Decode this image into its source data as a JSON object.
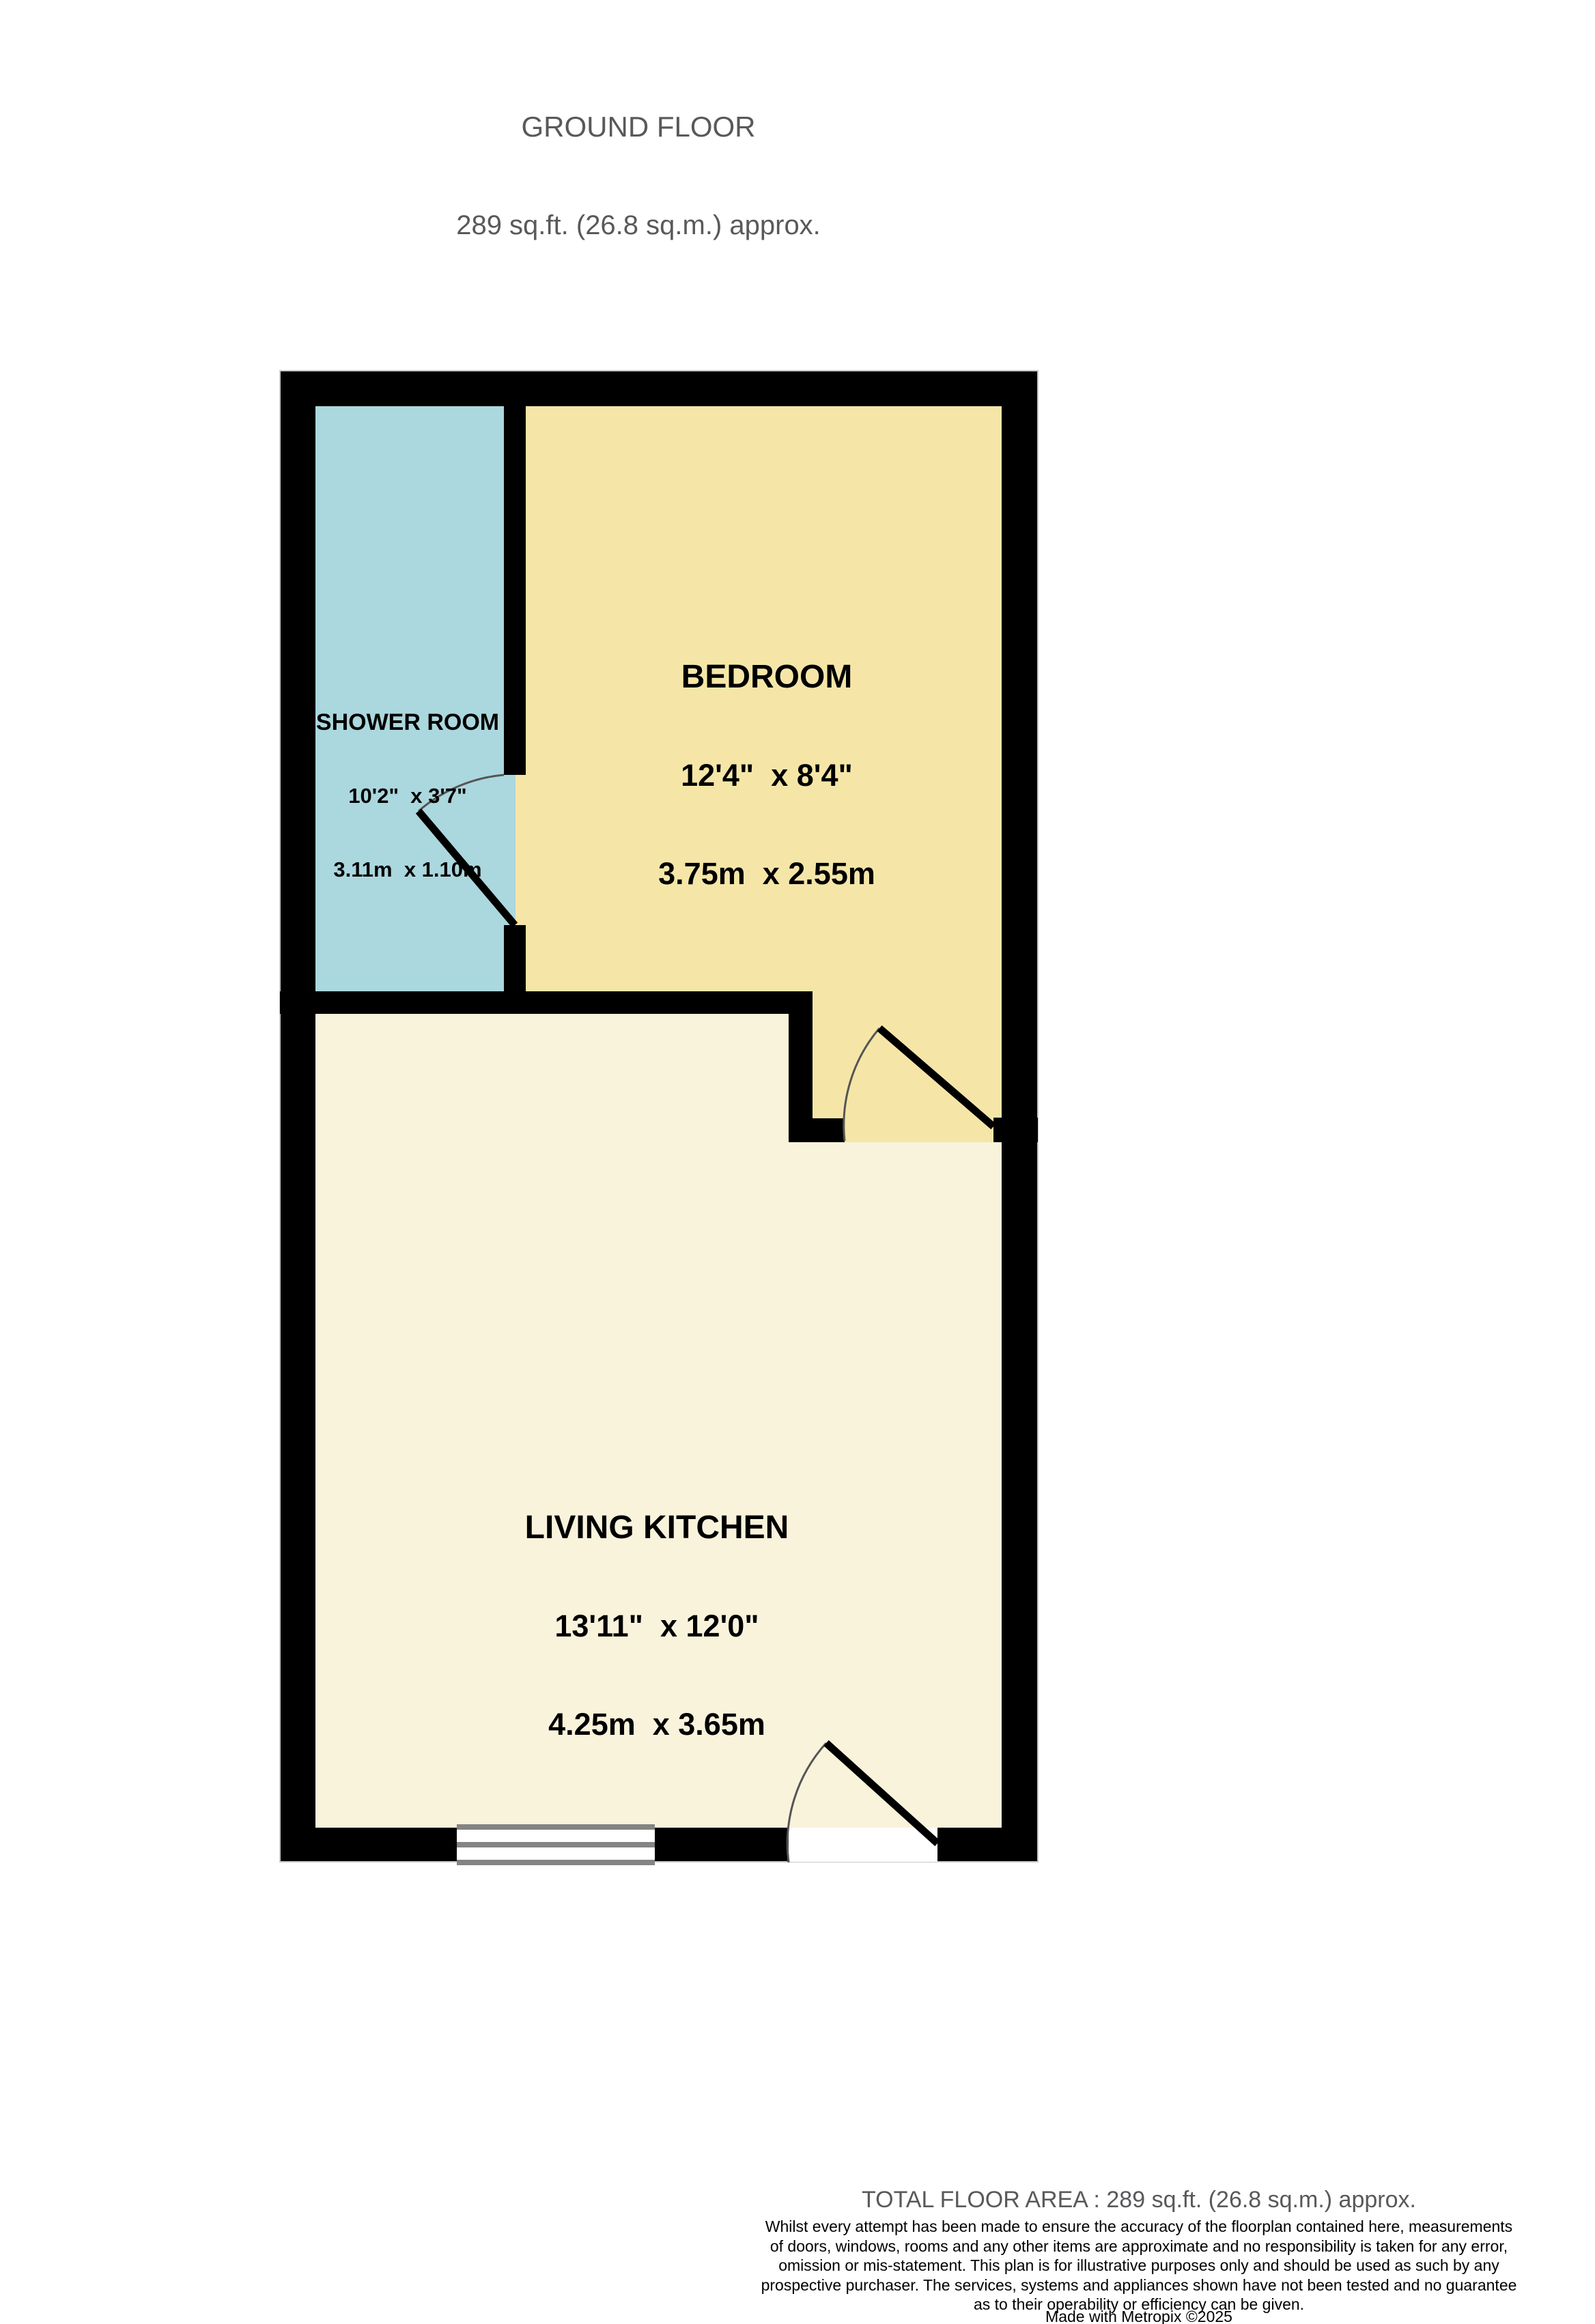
{
  "header": {
    "title": "GROUND FLOOR",
    "subtitle": "289 sq.ft. (26.8 sq.m.) approx."
  },
  "rooms": [
    {
      "name": "SHOWER ROOM",
      "imperial": "10'2\"  x 3'7\"",
      "metric": "3.11m  x 1.10m",
      "fill": "#abd7de"
    },
    {
      "name": "BEDROOM",
      "imperial": "12'4\"  x 8'4\"",
      "metric": "3.75m  x 2.55m",
      "fill": "#f5e6a8"
    },
    {
      "name": "LIVING KITCHEN",
      "imperial": "13'11\"  x 12'0\"",
      "metric": "4.25m  x 3.65m",
      "fill": "#f9f3dc"
    }
  ],
  "footer": {
    "total_area": "TOTAL FLOOR AREA : 289 sq.ft. (26.8 sq.m.) approx.",
    "disclaimer": "Whilst every attempt has been made to ensure the accuracy of the floorplan contained here, measurements\nof doors, windows, rooms and any other items are approximate and no responsibility is taken for any error,\nomission or mis-statement. This plan is for illustrative purposes only and should be used as such by any\nprospective purchaser. The services, systems and appliances shown have not been tested and no guarantee\nas to their operability or efficiency can be given.",
    "credit": "Made with Metropix ©2025"
  },
  "palette": {
    "wall": "#000000",
    "wall_outline": "#c8c8c8",
    "window_frame": "#848484",
    "window_glass": "#ffffff",
    "door_arc": "#555555",
    "door_leaf": "#000000",
    "muted_text": "#58595b"
  }
}
